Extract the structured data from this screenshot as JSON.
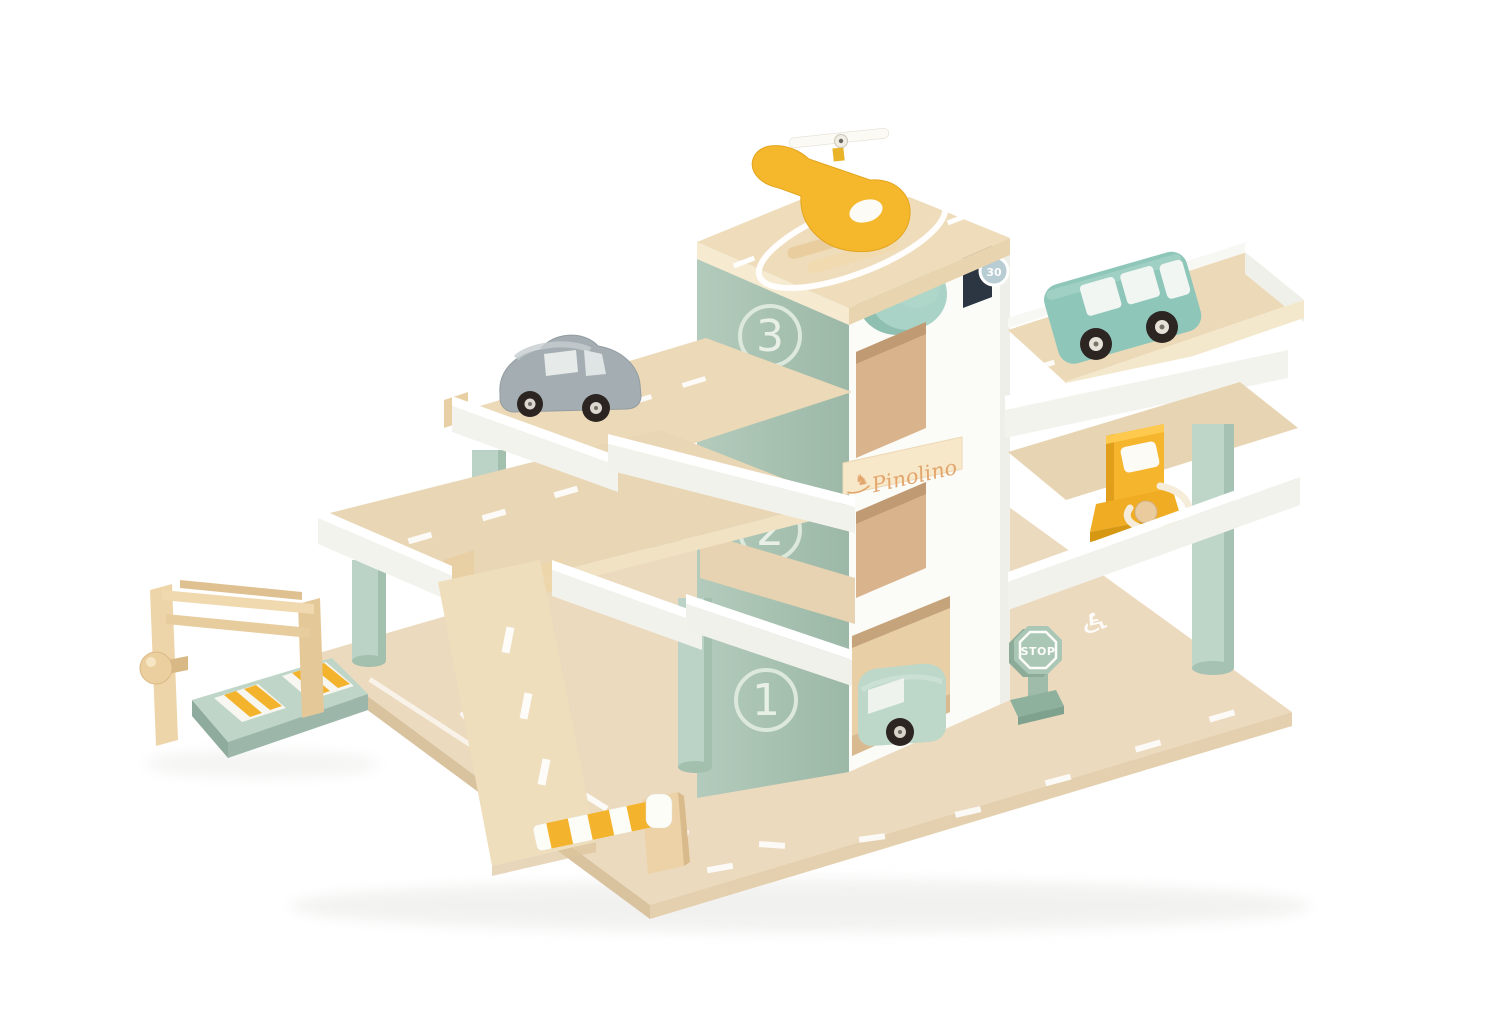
{
  "meta": {
    "type": "product-photo",
    "subject": "Pinolino wooden toy parking garage with three levels, car lift, ramp, rooftop helipad and vehicles",
    "background_color": "#ffffff"
  },
  "branding": {
    "logo_text": "Pinolino",
    "logo_icon": "rocking-horse",
    "logo_icon_glyph": "♞"
  },
  "levels": {
    "level3": "3",
    "level2": "2",
    "level1": "1"
  },
  "signs": {
    "stop": "STOP",
    "speed_limit": "30"
  },
  "markings": {
    "accessible_parking_glyph": "♿",
    "helipad": "white circle landing pad",
    "road_lines": "white dashed lane markings"
  },
  "vehicles": [
    {
      "name": "helicopter",
      "color": "#f5b72b",
      "location": "rooftop helipad"
    },
    {
      "name": "gray car",
      "color": "#a4aeb2",
      "location": "level 3 left deck"
    },
    {
      "name": "teal van",
      "color": "#8fc6ba",
      "location": "level 3 right deck"
    },
    {
      "name": "mint car",
      "color": "#bdd8c8",
      "location": "ground floor lift bay"
    }
  ],
  "accessories": [
    {
      "name": "fuel pump",
      "color": "#f5b52d"
    },
    {
      "name": "car lift",
      "color": "#bed5c7"
    },
    {
      "name": "barrier boom",
      "colors": "white and yellow stripes"
    },
    {
      "name": "stop sign",
      "color": "#aac7b5"
    }
  ],
  "colors": {
    "wood": "#ecdabe",
    "white_paint": "#fbfbf8",
    "sage_panel": "#a9c3b2",
    "mint_pillar": "#bad3c6",
    "teal_knob": "#a8d3c6",
    "accent_yellow": "#f3b32d"
  }
}
